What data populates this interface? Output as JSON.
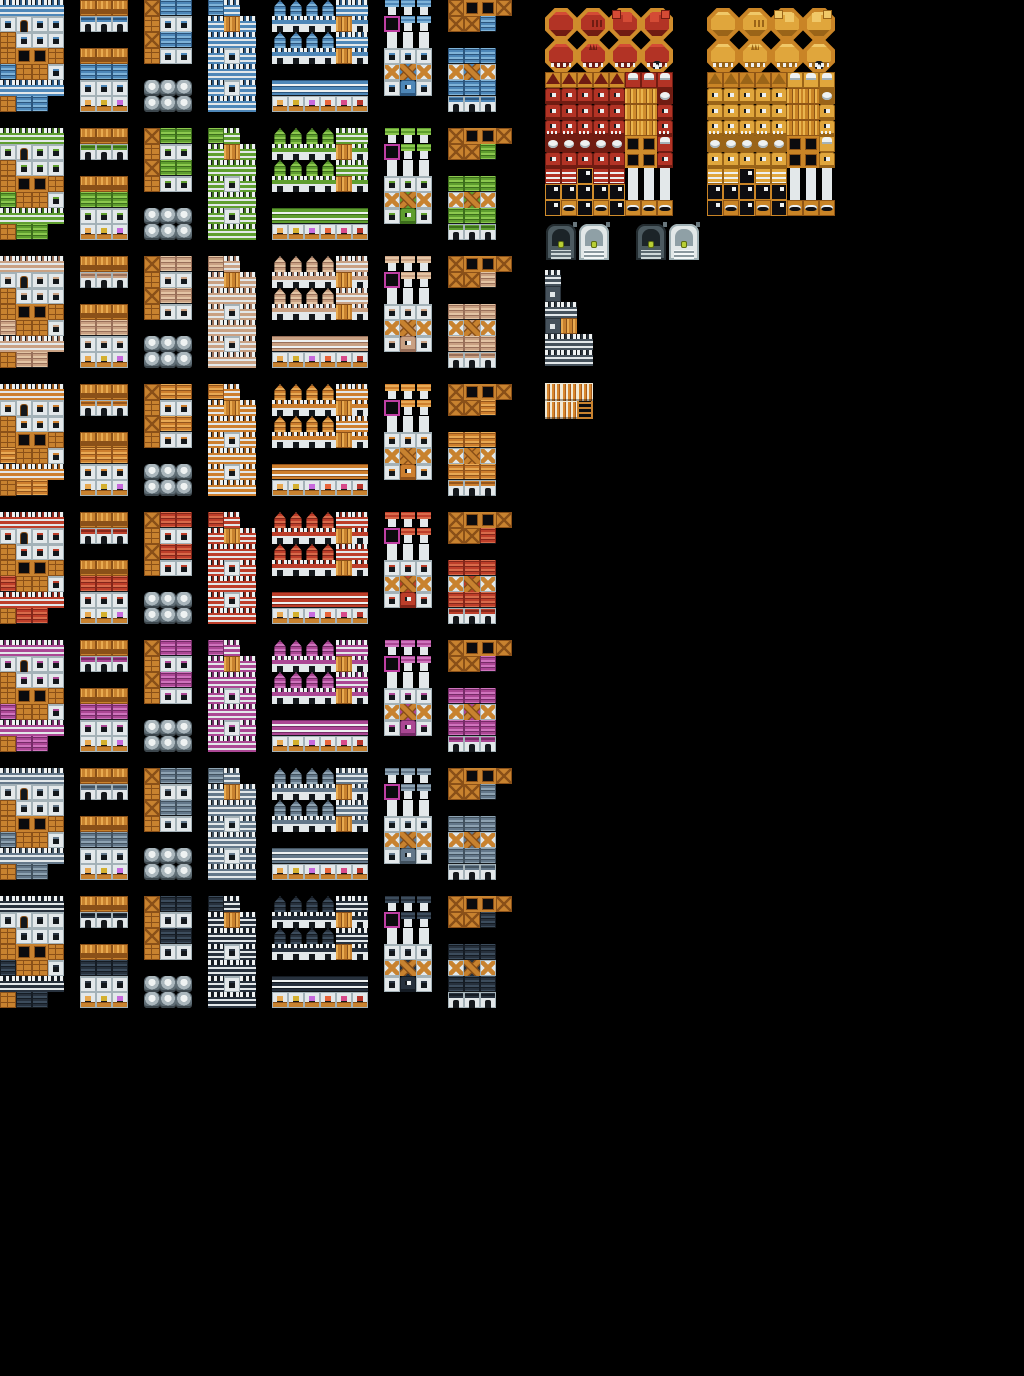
{
  "meta": {
    "description": "Pixel-art town/building tileset sprite sheet on black background",
    "canvas": {
      "width": 1024,
      "height": 1376,
      "background": "#000000"
    },
    "tile_size": 16
  },
  "shared_colors": {
    "wood": "#c8822f",
    "wood_dark": "#8a5018",
    "wood_light": "#e8aa50",
    "wall": "#e3e8ea",
    "wall_shadow": "#a4b2b8",
    "outline": "#14181c",
    "white": "#eef1f1",
    "accent_magenta": "#bf3fa3",
    "goods": [
      "#e8a84f",
      "#d4b02f",
      "#c76adc",
      "#e8643a",
      "#d84a8a",
      "#b8352a"
    ]
  },
  "legend": {
    ".": "empty",
    "b": "battlement-wall",
    "w": "wall-window",
    "W": "dark-wall-window",
    "d": "wall-door",
    "f": "wood-panel",
    "F": "wood-frame",
    "r": "roof",
    "s": "roof-spire",
    "K": "castle-base",
    "P": "wood-planks",
    "A": "awning",
    "t": "shop-front",
    "g": "house-front",
    "o": "ornate-wood-eave",
    "c": "small-cap",
    "M": "accent-frame-box",
    "u": "pedestal",
    "x": "cross-braced-wall",
    "X": "cross-braced-wall-large",
    "C": "crate",
    "O": "stone-pot",
    "m": "creature-face",
    "n": "creature-face-teeth",
    "p": "pointed-cap",
    "T": "throne",
    "E": "eye-pod",
    "z": "striped-banner",
    "k": "dark-sign",
    "H": "gold-teeth",
    "v": "vertical-stripes",
    "L": "ladder"
  },
  "palette_rows": [
    {
      "name": "blue",
      "y": 0,
      "colors": {
        "main": "#4e87b8",
        "dark": "#2c567e",
        "light": "#7fb3d8"
      }
    },
    {
      "name": "green",
      "y": 128,
      "colors": {
        "main": "#5f9e2f",
        "dark": "#3d6e1c",
        "light": "#8cc84e"
      }
    },
    {
      "name": "tan",
      "y": 256,
      "colors": {
        "main": "#c9a183",
        "dark": "#99705a",
        "light": "#e3c4a4"
      }
    },
    {
      "name": "orange",
      "y": 384,
      "colors": {
        "main": "#cd7f2e",
        "dark": "#94551c",
        "light": "#e8a954"
      }
    },
    {
      "name": "red",
      "y": 512,
      "colors": {
        "main": "#bd3e2a",
        "dark": "#84261a",
        "light": "#d86a4a"
      }
    },
    {
      "name": "purple",
      "y": 640,
      "colors": {
        "main": "#ab4794",
        "dark": "#762c68",
        "light": "#cf74bd"
      }
    },
    {
      "name": "slate",
      "y": 768,
      "colors": {
        "main": "#64788a",
        "dark": "#42525f",
        "light": "#8ea3b2"
      }
    },
    {
      "name": "midnight",
      "y": 896,
      "colors": {
        "main": "#27313d",
        "dark": "#151c24",
        "light": "#3c4c5c"
      }
    }
  ],
  "groups": [
    {
      "name": "house-block",
      "x": 0,
      "map": [
        "bbbb",
        "wdww",
        "fwww",
        "fFFf",
        "rffw",
        "bbbb",
        "frr."
      ]
    },
    {
      "name": "roof-shop-column",
      "x": 80,
      "map": [
        "ooo",
        "ggg",
        "...",
        "ooo",
        "rrr",
        "www",
        "ttt"
      ]
    },
    {
      "name": "storehouse-column",
      "x": 144,
      "map": [
        "Crr",
        "fww",
        "Crr",
        "fww",
        "...",
        "OOO",
        "OOO"
      ]
    },
    {
      "name": "wall-column",
      "x": 208,
      "map": [
        "rb.",
        "bPb",
        "bbb",
        "bwb",
        "bbb",
        "bwb",
        "bbb"
      ]
    },
    {
      "name": "castle-and-shops",
      "x": 272,
      "map": [
        "ssssbb",
        "KKKKPK",
        "ssssbb",
        "KKKKPK",
        "......",
        "AAAAAA",
        "tttttt"
      ]
    },
    {
      "name": "wells-and-cottages",
      "x": 384,
      "map": [
        "ccc",
        "Mcc",
        "uuu",
        "www",
        "xXx",
        "wmw"
      ]
    },
    {
      "name": "crates-and-roofs",
      "x": 448,
      "map": [
        "CFFC",
        "CCr.",
        "....",
        "rrr.",
        "xXx.",
        "rrr.",
        "ggg."
      ]
    }
  ],
  "sprite_blocks": [
    {
      "name": "boss-tiles-red",
      "x": 545,
      "y": 8,
      "colors": {
        "body": "#b23325",
        "body_dark": "#701c12",
        "body_light": "#d44b35",
        "frame": "#cf8c2c",
        "frame_dark": "#8f5516",
        "frame_light": "#eab54e"
      },
      "dome_rows": [
        [
          "plain",
          "marked",
          "cubes-left",
          "cubes-right"
        ],
        [
          "footed",
          "clawed",
          "spiked",
          "horned-skull"
        ]
      ],
      "map": [
        "pppppTTT",
        "mmmmmPPE",
        "mmmmmPPm",
        "nnnnnPPn",
        "EEEEEFFT",
        "mmmmmFFm",
        "zzkzzuuu",
        "kkkkkuuu",
        "kHkHkHHH"
      ]
    },
    {
      "name": "boss-tiles-gold",
      "x": 707,
      "y": 8,
      "colors": {
        "body": "#e0a63c",
        "body_dark": "#9a6418",
        "body_light": "#f0c868",
        "frame": "#c98426",
        "frame_dark": "#8f5516",
        "frame_light": "#eab54e"
      },
      "dome_rows": [
        [
          "plain",
          "marked",
          "cubes-left",
          "cubes-right"
        ],
        [
          "footed",
          "clawed",
          "spiked",
          "horned-skull"
        ]
      ],
      "map": [
        "pppppTTT",
        "mmmmmPPE",
        "mmmmmPPm",
        "nnnnnPPn",
        "EEEEEFFT",
        "mmmmmFFm",
        "zzkzzuuu",
        "kkkkkuuu",
        "kHkHkHHH"
      ]
    }
  ],
  "gates": {
    "y": 224,
    "keystone": "#b9cf35",
    "variants": {
      "dark": {
        "body": "#4c5a60",
        "shadow": "#232c30",
        "arch": "#1c2428",
        "step1": "#cfd8d8",
        "step2": "#5c6a70"
      },
      "light": {
        "body": "#e2e8e8",
        "shadow": "#9fb0b4",
        "arch": "#8fa0a6",
        "step1": "#f4f8f8",
        "step2": "#8a989e"
      }
    },
    "items": [
      {
        "variant": "dark",
        "x": 545
      },
      {
        "variant": "light",
        "x": 578
      },
      {
        "variant": "dark",
        "x": 635
      },
      {
        "variant": "light",
        "x": 668
      }
    ]
  },
  "tower": {
    "name": "castle-tower",
    "x": 545,
    "y": 270,
    "colors": {
      "main": "#46525c",
      "dark": "#2b343c",
      "light": "#5c6a76"
    },
    "map": [
      "b...",
      "W...",
      "bb..",
      "WP..",
      "bbb.",
      "bbb."
    ]
  },
  "stripes": {
    "name": "striped-curtain",
    "x": 545,
    "y": 383,
    "tile_height": 18,
    "map": [
      "vvv",
      "vvL"
    ]
  }
}
